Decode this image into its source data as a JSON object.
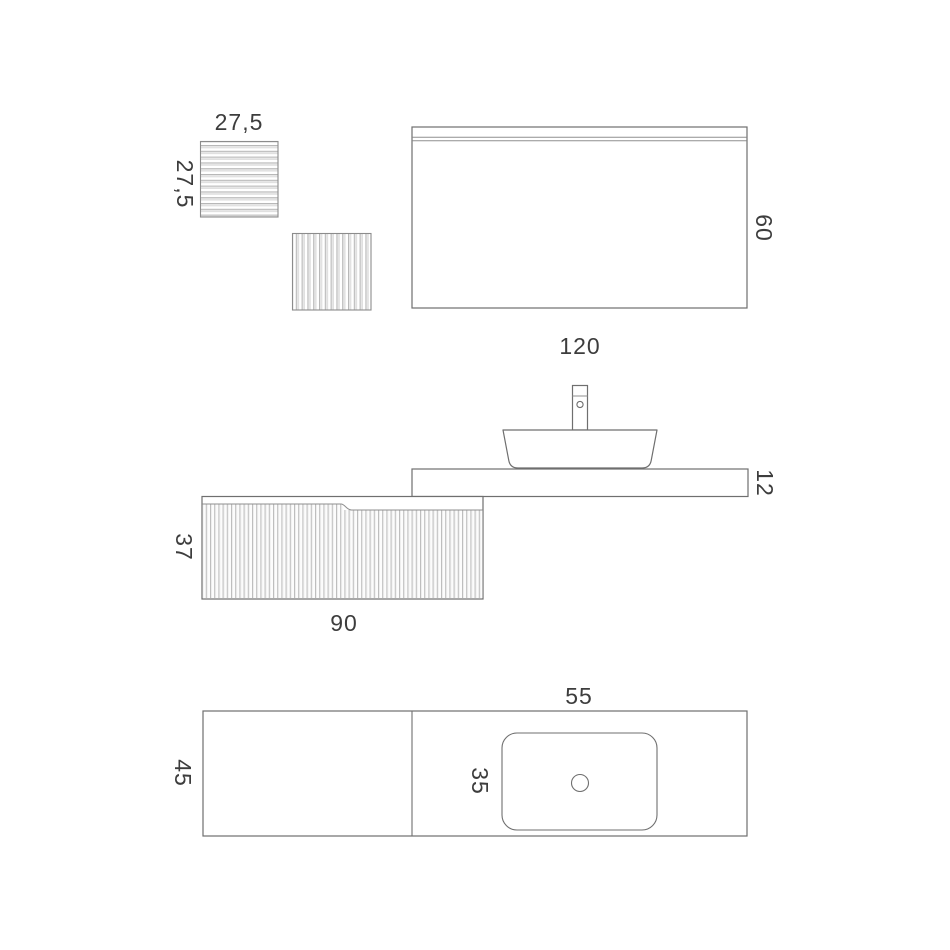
{
  "colors": {
    "background": "#ffffff",
    "line": "#6f6f6f",
    "line_light": "#8f8f8f",
    "rib": "#b6b6b6",
    "text": "#3d3d3d"
  },
  "views": {
    "panels": {
      "front_width": "27,5",
      "front_height": "27,5"
    },
    "mirror": {
      "width": "120",
      "height": "60"
    },
    "side": {
      "countertop_thickness": "12",
      "cabinet_height": "37",
      "cabinet_width": "90"
    },
    "top": {
      "countertop_depth": "45",
      "basin_width": "55",
      "basin_depth": "35"
    }
  }
}
